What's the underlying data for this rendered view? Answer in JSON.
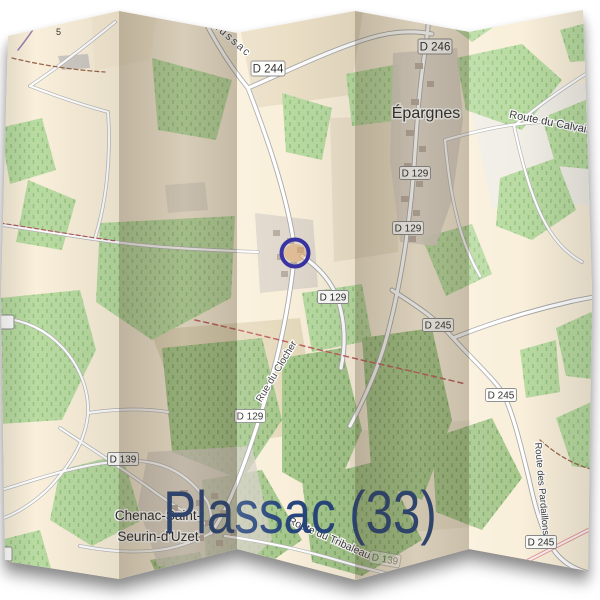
{
  "title": {
    "text": "Plassac (33)"
  },
  "colors": {
    "title_blue": "#28467d",
    "marker_ring": "#3a34a4",
    "paper_cream": "#f9efda",
    "forest_light": "#b9dba2",
    "forest_dark": "#a5c78b",
    "fold_shade": "rgba(72,58,36,0.30)"
  },
  "map": {
    "road_labels": [
      {
        "text": "D 244"
      },
      {
        "text": "D 246"
      },
      {
        "text": "D 129"
      },
      {
        "text": "D 129"
      },
      {
        "text": "D 129"
      },
      {
        "text": "D 129"
      },
      {
        "text": "D 139"
      },
      {
        "text": "D 245"
      },
      {
        "text": "D 245"
      },
      {
        "text": "D 245"
      },
      {
        "text": "D 139"
      }
    ],
    "street_labels": [
      {
        "text": "mussac"
      },
      {
        "text": "Route du Calvaire"
      },
      {
        "text": "Rue du Clocher"
      },
      {
        "text": "Route du Tribaleau"
      },
      {
        "text": "Route des Pardaillons"
      }
    ],
    "place_labels": [
      {
        "text": "Épargnes"
      },
      {
        "text": "Chenac-Saint-"
      },
      {
        "text": "Seurin-d'Uzet"
      }
    ],
    "tiny_labels": [
      {
        "text": "5"
      }
    ]
  }
}
